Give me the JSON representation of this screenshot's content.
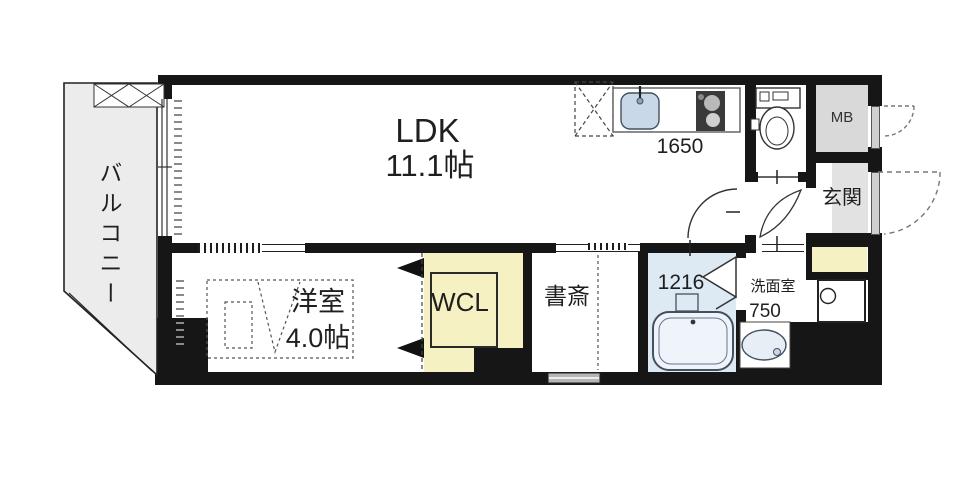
{
  "floorplan": {
    "title": "1LDK apartment floor plan",
    "labels": {
      "balcony": "バルコニー",
      "ldk": "LDK",
      "ldk_size": "11.1帖",
      "kitchen_width": "1650",
      "meter_box": "MB",
      "entrance": "玄関",
      "western_room": "洋室",
      "western_room_size": "4.0帖",
      "walk_in_closet": "WCL",
      "study": "書斎",
      "bath_unit_size": "1216",
      "washroom": "洗面室",
      "washroom_width": "750"
    },
    "colors": {
      "wall": "#161616",
      "balcony_fill": "#ececec",
      "meter_box_fill": "#d9d9d9",
      "entrance_fill": "#e2e2e2",
      "closet_fill": "#f6f1c2",
      "bathroom_fill": "#dde9f3",
      "fixture_fill": "#c9d8e9",
      "door_fill": "#cfcfcf",
      "window_frame": "#b5b5b5"
    }
  }
}
